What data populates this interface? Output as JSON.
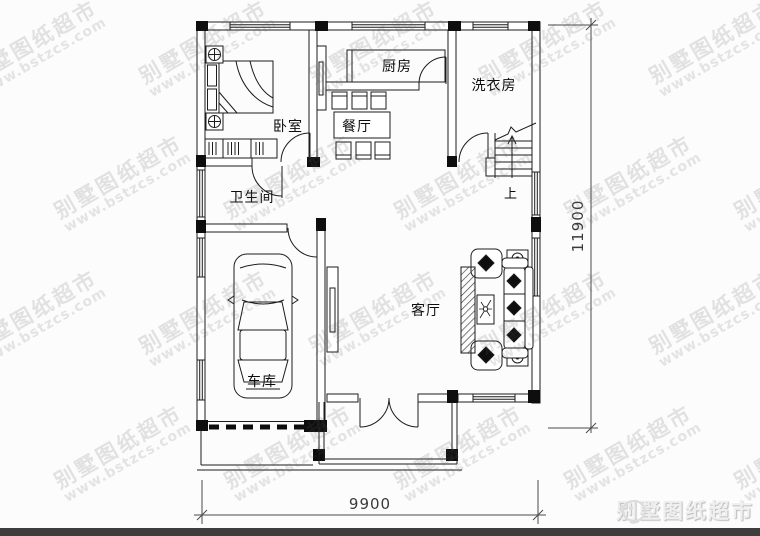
{
  "labels": {
    "bedroom": "卧室",
    "kitchen": "厨房",
    "laundry": "洗衣房",
    "dining": "餐厅",
    "bathroom": "卫生间",
    "living": "客厅",
    "garage": "车库",
    "stairs_up": "上"
  },
  "dimensions": {
    "bottom": "9900",
    "right": "11900"
  },
  "watermark": {
    "line1": "别墅图纸超市",
    "line2": "www.bstzcs.com"
  },
  "logo": {
    "text": "别墅图纸超市"
  },
  "colors": {
    "line": "#1c1c1c",
    "watermark": "rgba(90,90,90,0.16)",
    "bottom_bar": "#3d3d3d",
    "logo_text": "#efefef"
  }
}
